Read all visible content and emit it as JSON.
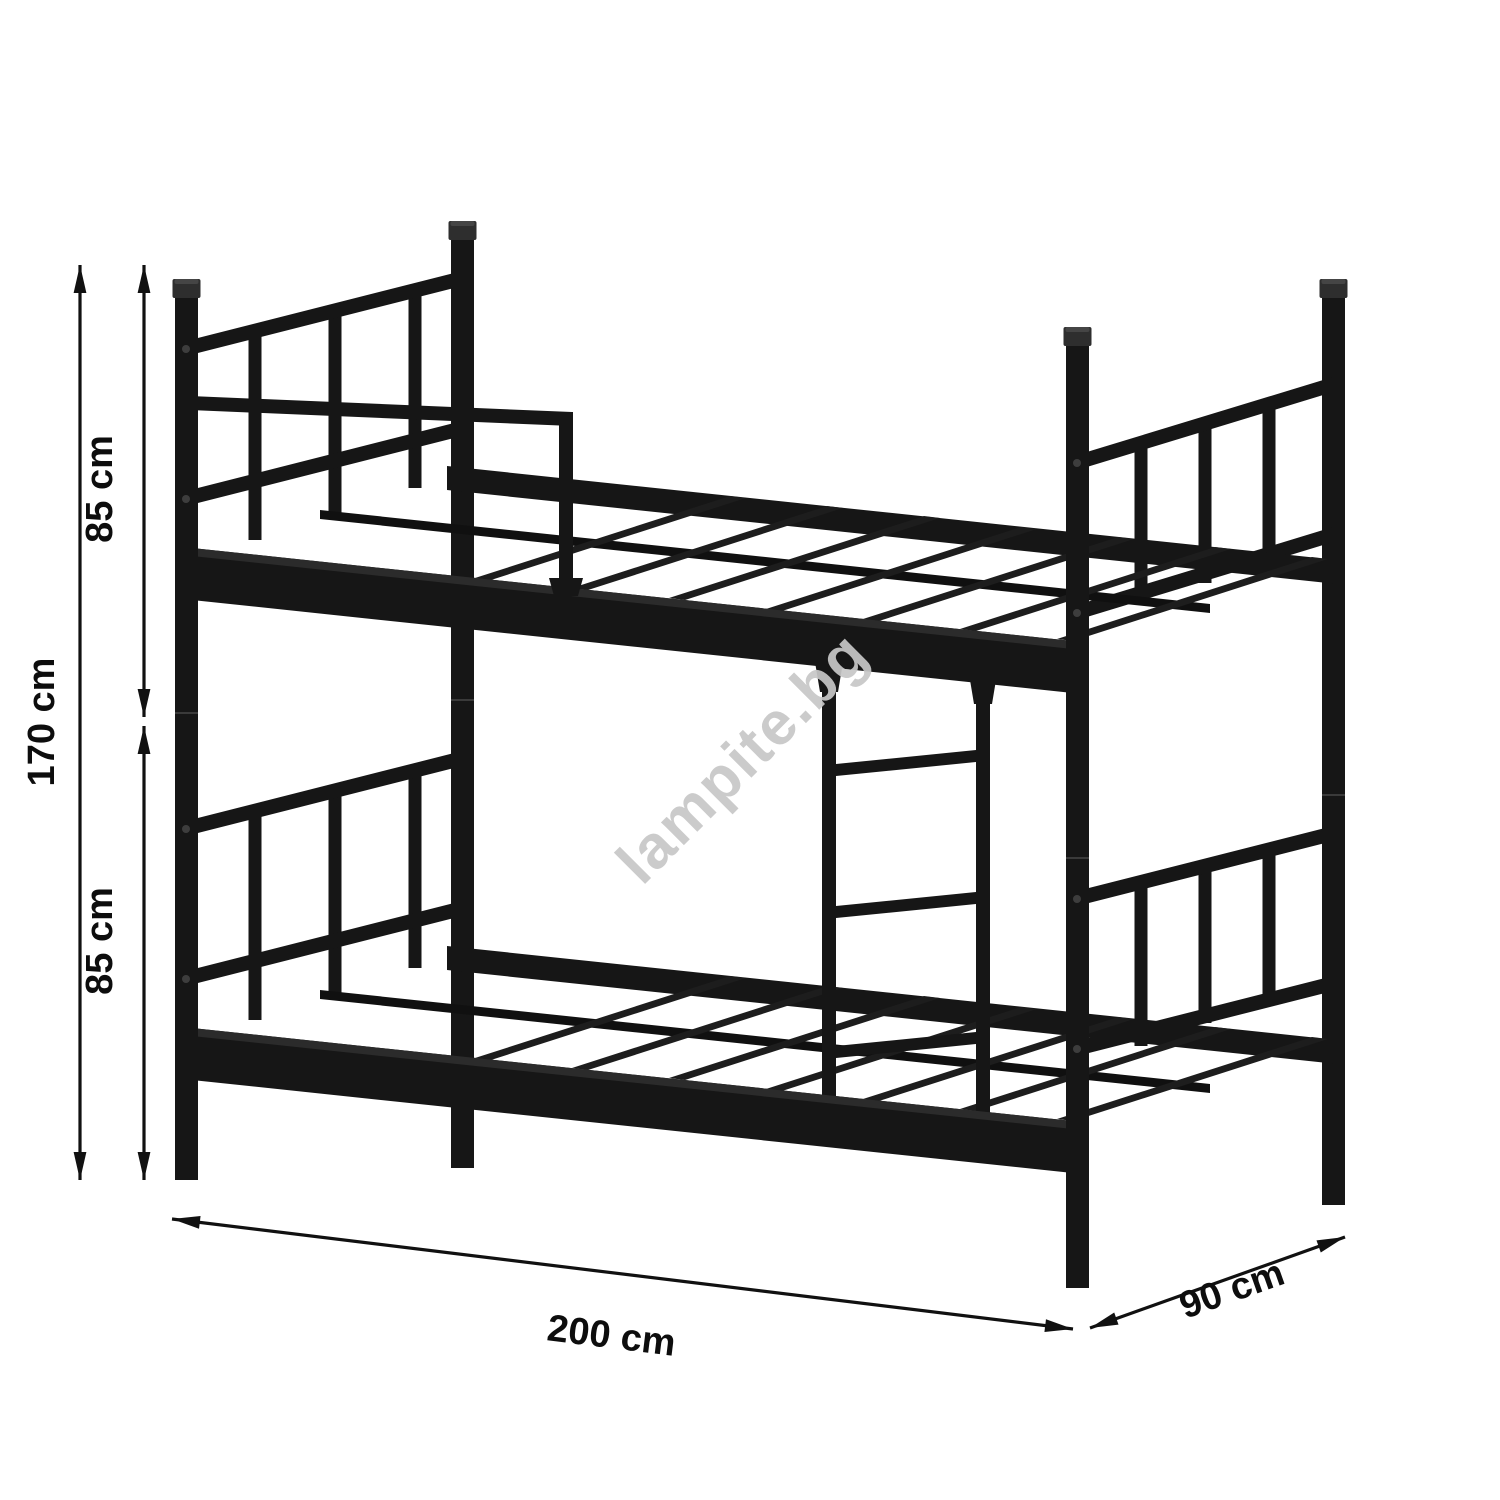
{
  "diagram": {
    "subject": "metal bunk bed frame",
    "watermark": "lampite.bg",
    "dimensions": {
      "total_height": "170 cm",
      "upper_section_height": "85 cm",
      "lower_section_height": "85 cm",
      "length": "200 cm",
      "depth": "90 cm"
    },
    "colors": {
      "frame": "#161616",
      "dimension_lines": "#111111",
      "watermark": "#c7c7c7",
      "background": "#ffffff"
    }
  }
}
